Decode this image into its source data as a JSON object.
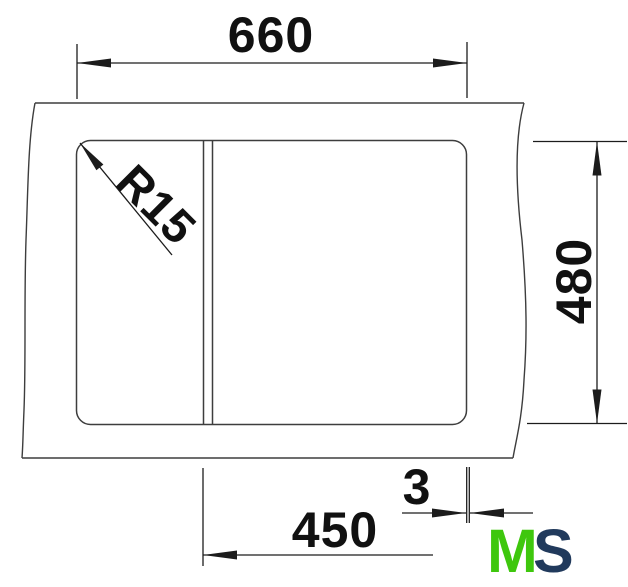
{
  "drawing": {
    "labels": {
      "overall_width": "660",
      "overall_depth": "480",
      "bowl_width": "450",
      "edge_gap": "3",
      "corner_radius": "R15"
    },
    "logo": {
      "letter_m": "M",
      "letter_s": "S"
    },
    "colors": {
      "line": "#3d3d3d",
      "dim": "#1c1c1c",
      "text": "#111111",
      "logo_green": "#3ec70d",
      "logo_navy": "#213a5c"
    }
  }
}
